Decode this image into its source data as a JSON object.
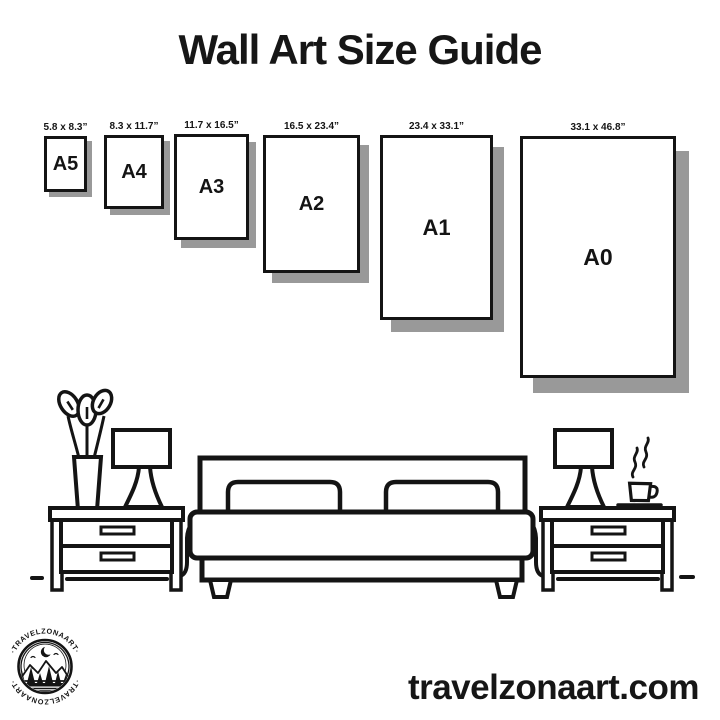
{
  "page": {
    "title": "Wall Art Size Guide",
    "website": "travelzonaart.com"
  },
  "palette": {
    "ink": "#141414",
    "shadow": "#999999",
    "background": "#ffffff"
  },
  "frames": [
    {
      "name": "A5",
      "dimensions": "5.8 x 8.3”"
    },
    {
      "name": "A4",
      "dimensions": "8.3 x 11.7”"
    },
    {
      "name": "A3",
      "dimensions": "11.7 x 16.5”"
    },
    {
      "name": "A2",
      "dimensions": "16.5 x 23.4”"
    },
    {
      "name": "A1",
      "dimensions": "23.4 x 33.1”"
    },
    {
      "name": "A0",
      "dimensions": "33.1 x 46.8”"
    }
  ],
  "logo": {
    "brand": "TRAVELZONAART",
    "ring_text_top": "·TRAVELZONAART·",
    "ring_text_bottom": "·TRAVELZONAART·"
  },
  "illustration": {
    "items": [
      "potted-plant",
      "table-lamp",
      "nightstand",
      "double-bed",
      "nightstand",
      "table-lamp",
      "coffee-cup"
    ]
  }
}
